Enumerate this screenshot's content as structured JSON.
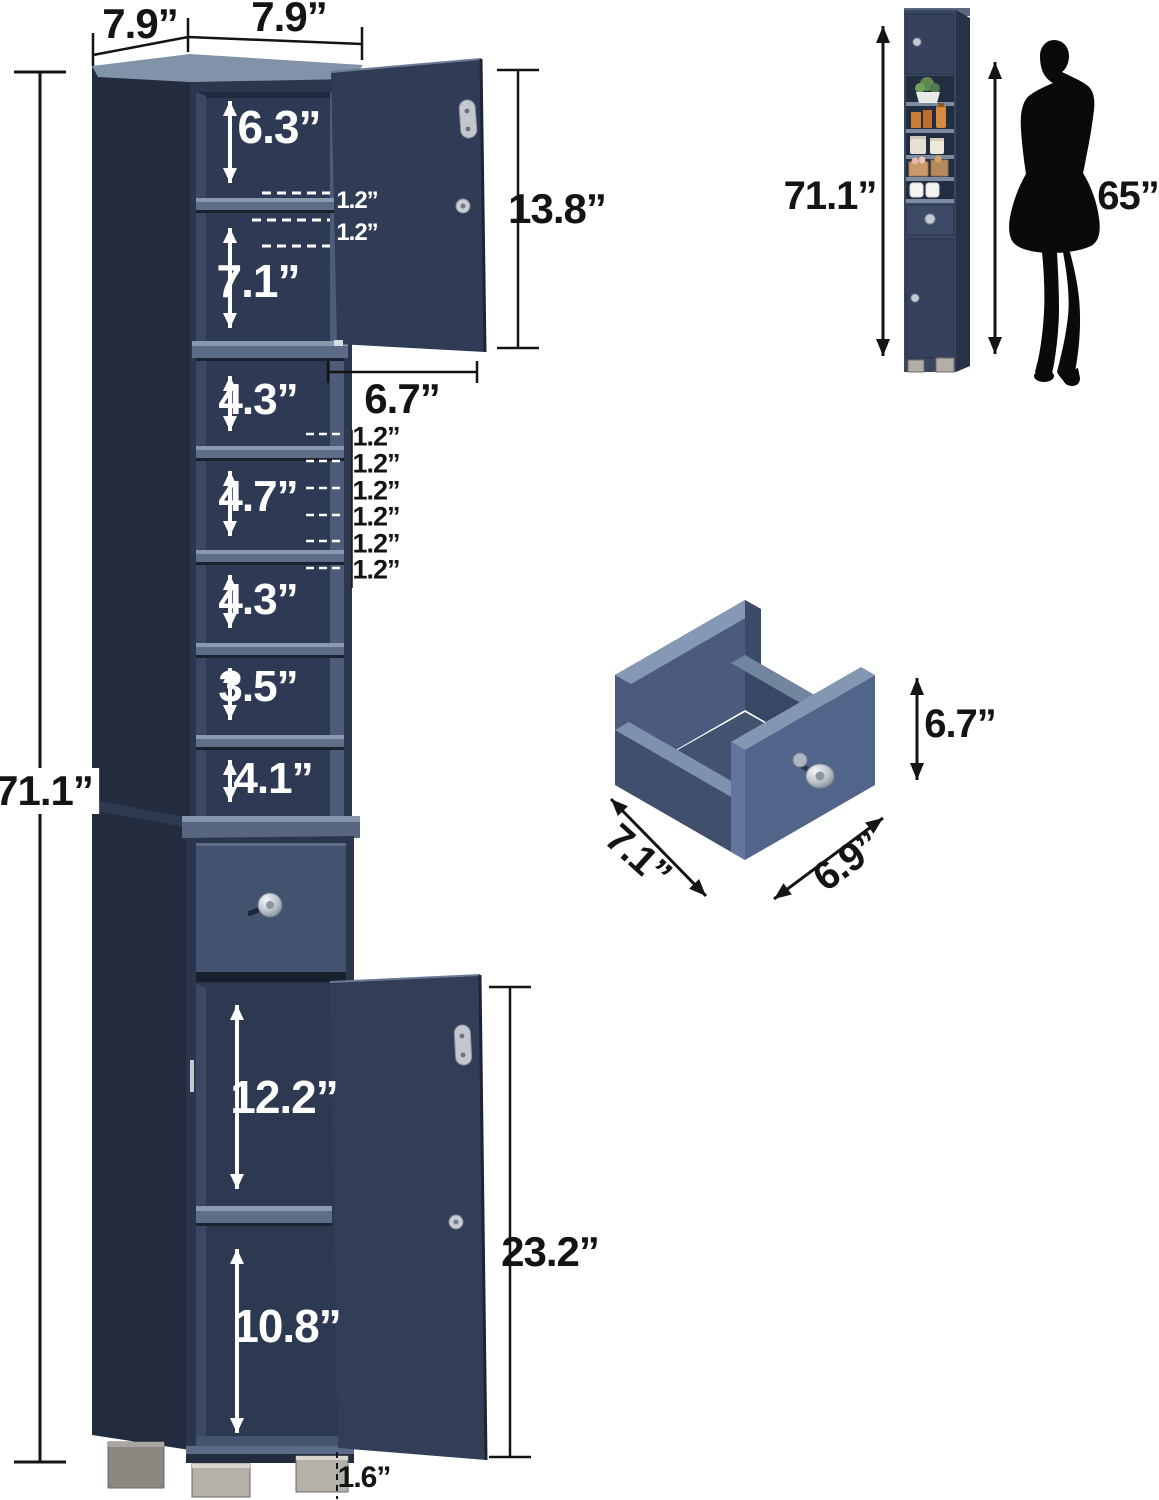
{
  "colors": {
    "cabinet_navy": "#2e3a52",
    "cabinet_dark": "#232d40",
    "shelf_edge": "#8b99ae",
    "metal_silver": "#c3c8cf",
    "foot_silver": "#b5b0aa",
    "annotation_black": "#141414",
    "annotation_white": "#ffffff"
  },
  "main_view": {
    "top_depth": "7.9”",
    "top_width": "7.9”",
    "total_height": "71.1”",
    "shelf_gaps": [
      "6.3”",
      "7.1”",
      "4.3”",
      "4.7”",
      "4.3”",
      "3.5”",
      "4.1”"
    ],
    "door_pin_gaps": [
      "1.2”",
      "1.2”"
    ],
    "side_pin_gaps": [
      "1.2”",
      "1.2”",
      "1.2”",
      "1.2”",
      "1.2”",
      "1.2”"
    ],
    "top_door_height": "13.8”",
    "top_door_width": "6.7”",
    "lower_open_top": "12.2”",
    "lower_open_bottom": "10.8”",
    "lower_door_height": "23.2”",
    "foot_height": "1.6”"
  },
  "scale_view": {
    "cabinet_height": "71.1”",
    "person_height": "65”"
  },
  "drawer_view": {
    "height": "6.7”",
    "depth": "7.1”",
    "width": "6.9”"
  }
}
